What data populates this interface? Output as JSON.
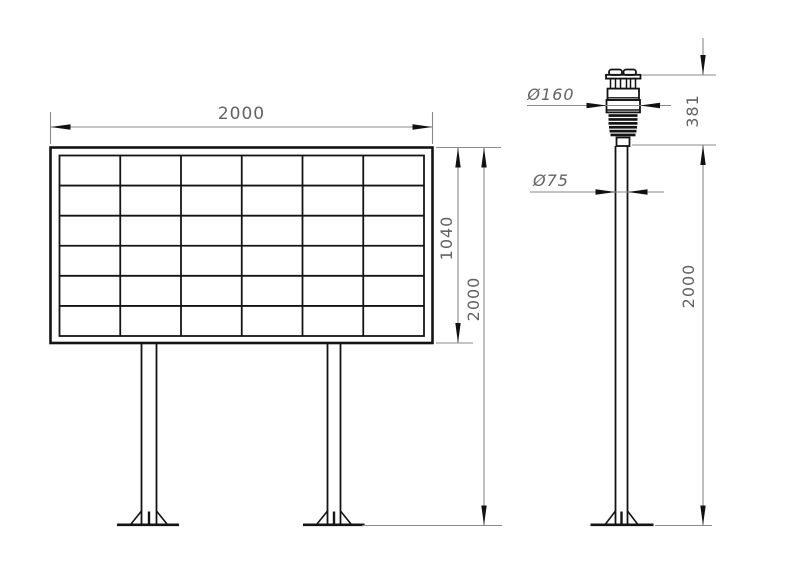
{
  "colors": {
    "background": "#ffffff",
    "object_line": "#141414",
    "dimension_line": "#8a8a8a",
    "dimension_text": "#636363",
    "arrow": "#111111"
  },
  "display_board": {
    "grid_rows": 6,
    "grid_cols": 6,
    "dims": {
      "width": "2000",
      "panel_height": "1040",
      "overall_height": "2000"
    }
  },
  "sensor_pole": {
    "dims": {
      "sensor_diameter": "Ø160",
      "sensor_height": "381",
      "pole_diameter": "Ø75",
      "pole_height": "2000"
    }
  }
}
